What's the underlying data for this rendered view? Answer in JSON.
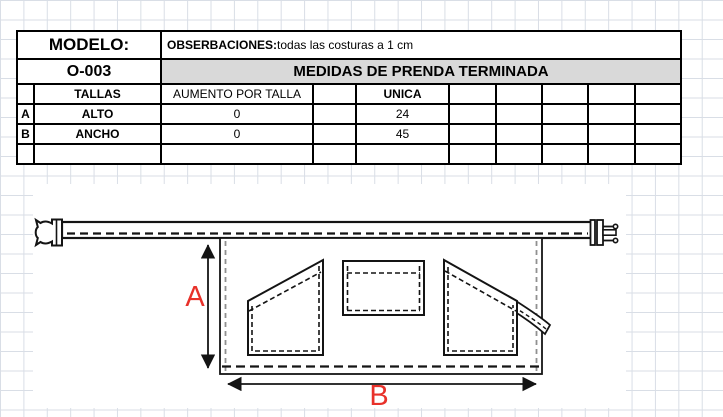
{
  "table": {
    "modelo_label": "MODELO:",
    "modelo_value": "O-003",
    "observaciones_label": "OBSERBACIONES:",
    "observaciones_text": " todas las costuras a 1 cm",
    "title": "MEDIDAS DE PRENDA TERMINADA",
    "columns": {
      "tallas": "TALLAS",
      "aumento": "AUMENTO POR TALLA",
      "unica": "UNICA"
    },
    "rows": [
      {
        "letter": "A",
        "name": "ALTO",
        "aumento": "0",
        "unica": "24"
      },
      {
        "letter": "B",
        "name": "ANCHO",
        "aumento": "0",
        "unica": "45"
      }
    ]
  },
  "drawing": {
    "dim_height_label": "A",
    "dim_width_label": "B"
  },
  "colors": {
    "dimension_label_red": "#e8312a",
    "table_header_gray": "#d9d9d9",
    "grid_line": "#d9dee6",
    "line_black": "#141414"
  }
}
